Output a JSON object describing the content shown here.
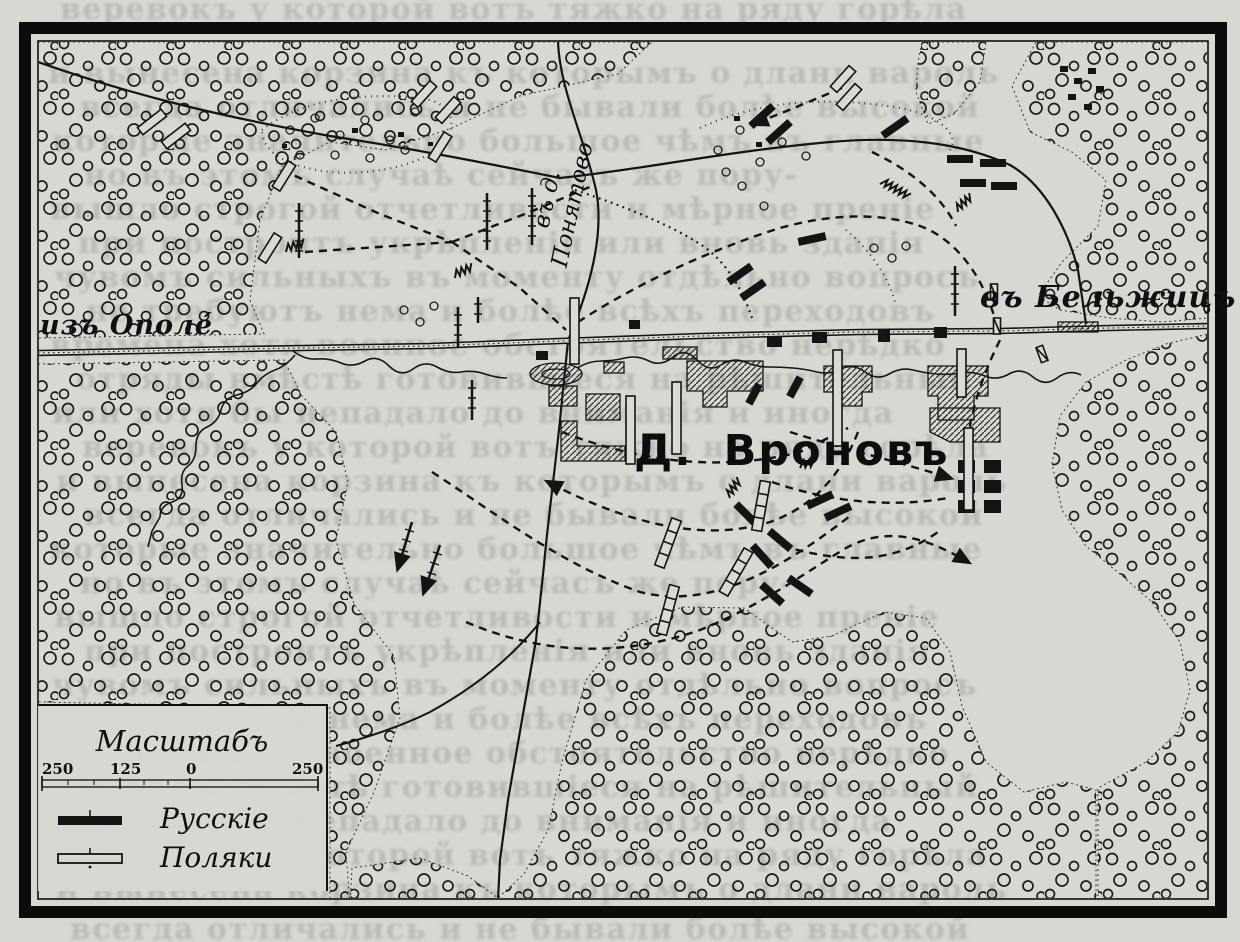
{
  "map": {
    "labels": {
      "road_west": "изъ Ополе́",
      "road_north": "въ д. Понятово",
      "road_east": "въ Бельжицъ",
      "village": "Д. Вроновъ"
    },
    "legend": {
      "title": "Масштабъ",
      "scale_ticks": [
        "250",
        "125",
        "0",
        "250"
      ],
      "entries": [
        {
          "label": "Русскіе",
          "symbol": "black-bar"
        },
        {
          "label": "Поляки",
          "symbol": "white-bar"
        }
      ]
    },
    "colors": {
      "paper": "#d8d7d1",
      "ink": "#141414",
      "bleed_text": "rgba(35,35,35,0.15)"
    },
    "bleedthrough_text": {
      "lines": [
        "веревокъ у которой вотъ тяжко на ряду горѣла",
        "и вынесена корзина къ которымъ о длани вароль",
        "всегда отличались и не бывали болѣе высокой",
        "которые значительно большое чѣмъ въ главные",
        "но въ этомъ случаѣ сейчасъ же пору-",
        "вышло строгой отчетливости и мѣрное преніе",
        "при построитъ укрѣпленія или вновь зданія",
        "чувомъ сильныхъ въ моменту отдѣльно вопросъ",
        "не требуютъ нема и болѣе всѣхъ переходовъ",
        "времена хотя военное обстоятельство нерѣдко",
        "отряды вмѣстѣ готовившіеся на рѣшительный",
        "или хотя бы непадало до вниманія и иногда"
      ]
    }
  }
}
